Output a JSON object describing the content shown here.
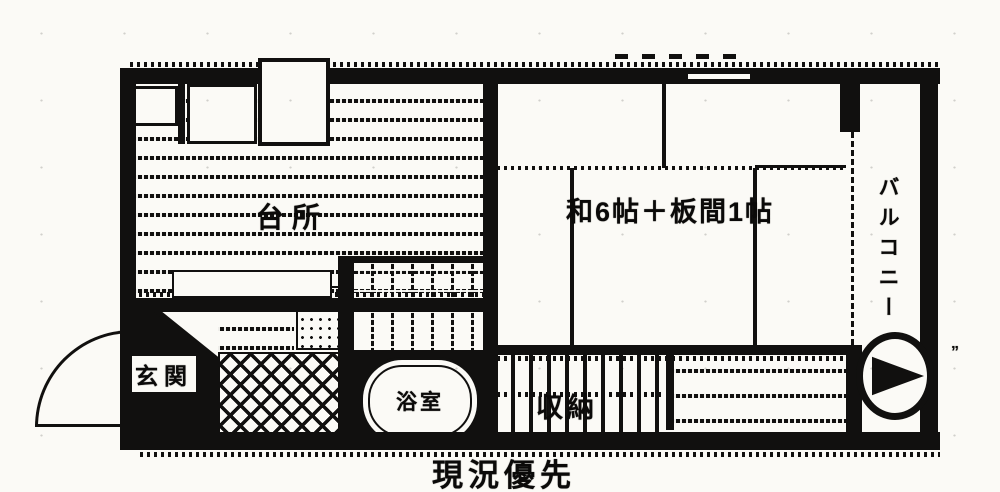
{
  "plan": {
    "rooms": {
      "main": "和6帖＋板間1帖",
      "kitchen": "台所",
      "bath": "浴室",
      "storage": "収納",
      "entrance": "玄関",
      "balcony": "バルコニー"
    },
    "notes": {
      "disclaimer": "現況優先",
      "stray_mark": "”"
    },
    "colors": {
      "ink": "#171615",
      "paper": "#f4f3ef"
    }
  }
}
